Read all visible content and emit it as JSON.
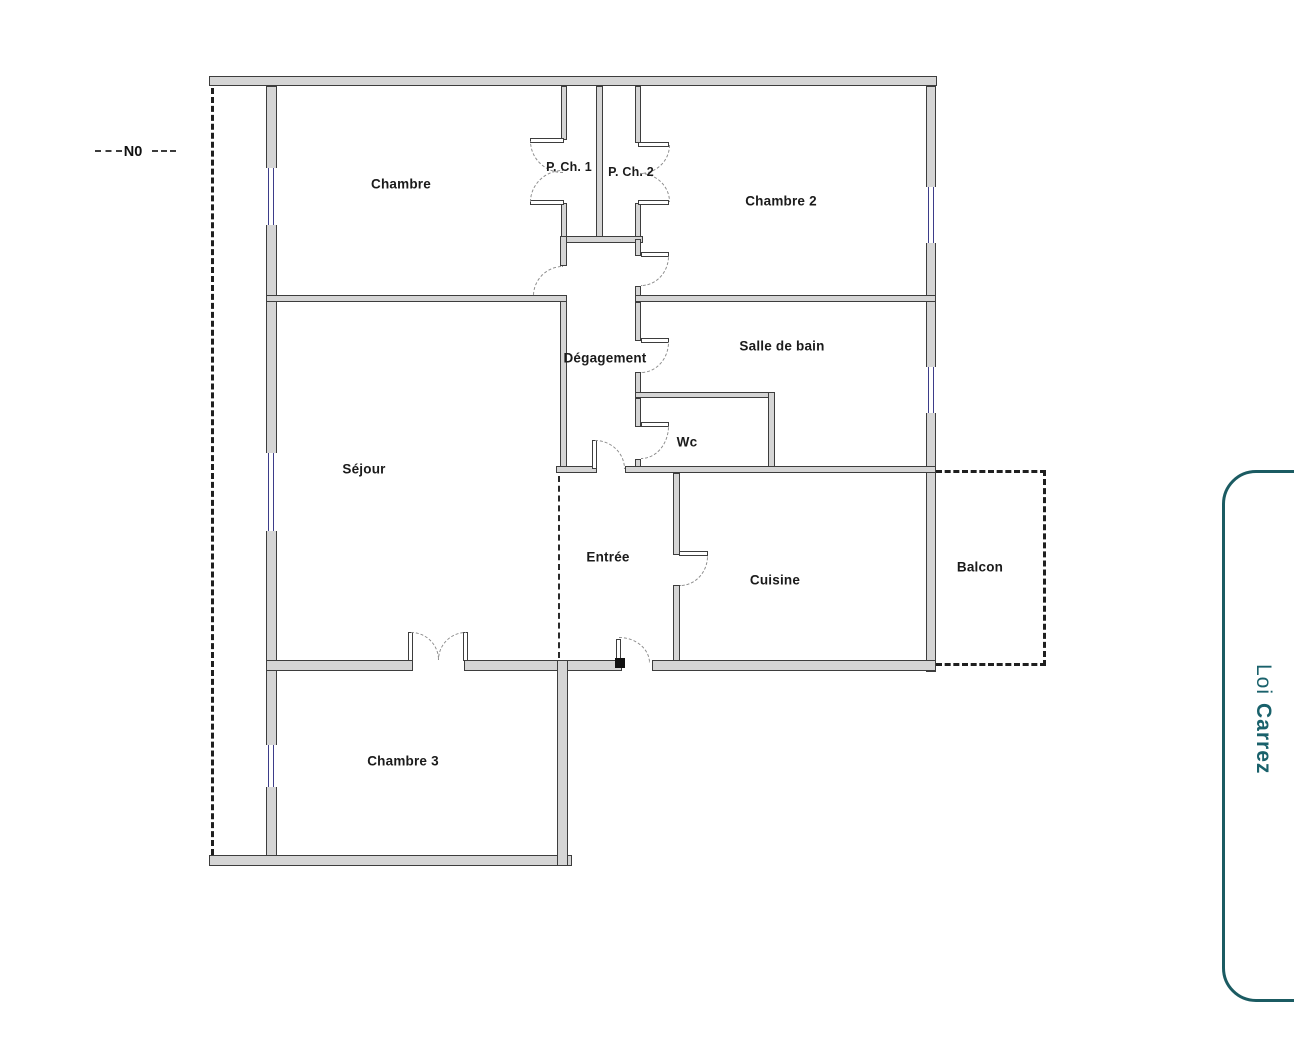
{
  "rooms": {
    "chambre": "Chambre",
    "p_ch_1": "P. Ch. 1",
    "p_ch_2": "P. Ch. 2",
    "chambre_2": "Chambre 2",
    "degagement": "Dégagement",
    "salle_de_bain": "Salle de bain",
    "wc": "Wc",
    "sejour": "Séjour",
    "entree": "Entrée",
    "cuisine": "Cuisine",
    "balcon": "Balcon",
    "chambre_3": "Chambre 3"
  },
  "compass": {
    "label": "N0"
  },
  "legend": {
    "prefix": "Loi",
    "brand": "Carrez"
  },
  "colors": {
    "wall_fill": "#d5d5d5",
    "wall_outline": "#3d3d3d",
    "window_frame": "#3d3d8a",
    "door_arc": "#8c8c8c",
    "boundary_dash": "#1f1f1f",
    "legend_teal": "#1b5b62",
    "label_text": "#1b1b1b"
  }
}
